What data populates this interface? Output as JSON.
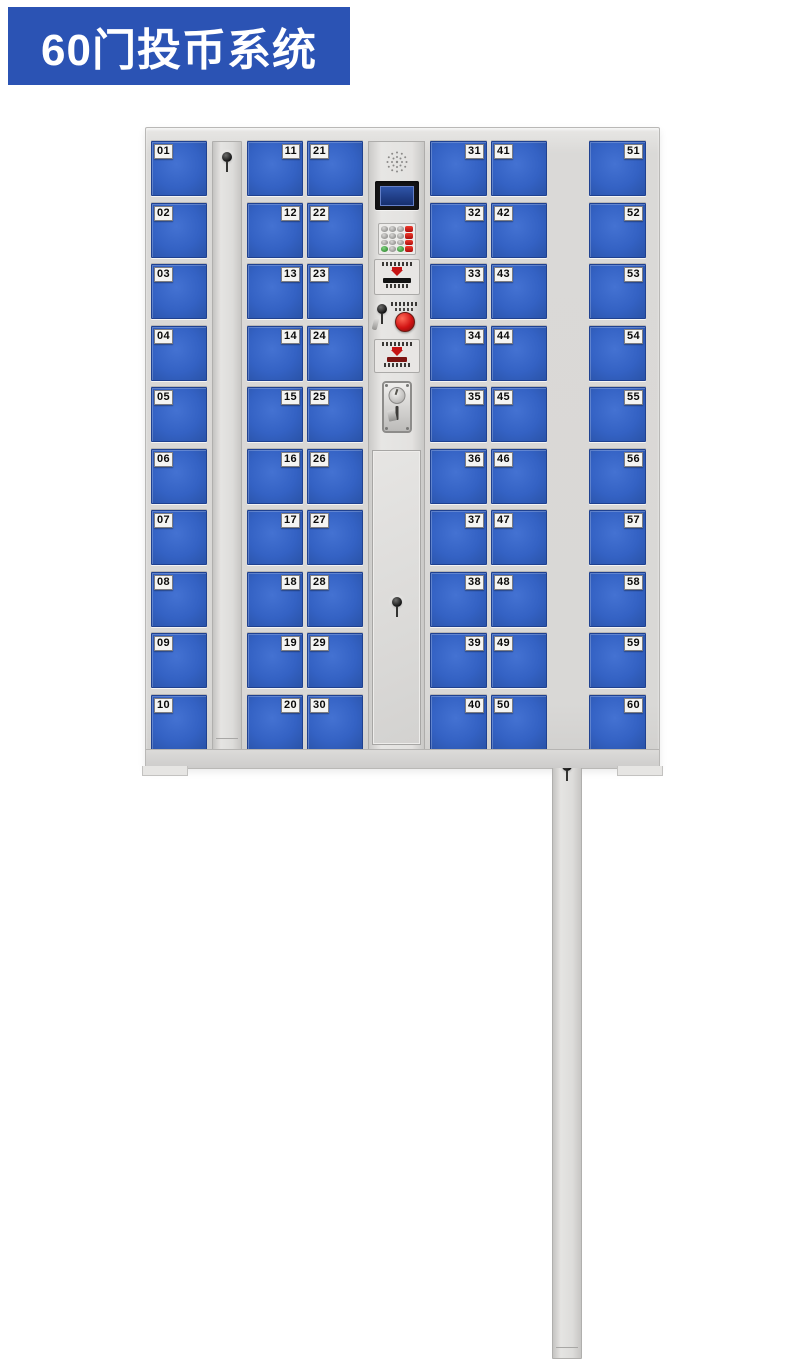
{
  "banner": {
    "title": "60门投币系统"
  },
  "colors": {
    "banner_bg": "#2b53b4",
    "banner_fg": "#ffffff",
    "door_blue": "#3462c4",
    "frame_gray": "#d9d8d6",
    "door_label_bg": "#f4f4f2",
    "lcd_screen_blue": "#23458f",
    "red_button": "#d21414",
    "keypad_red": "#c51f1a",
    "keypad_green": "#3a9a3a"
  },
  "locker": {
    "description": "60-door coin-operated storage cabinet, front view",
    "columns": [
      {
        "type": "doors",
        "label_side": "left",
        "doors": [
          "01",
          "02",
          "03",
          "04",
          "05",
          "06",
          "07",
          "08",
          "09",
          "10"
        ]
      },
      {
        "type": "lock",
        "name": "left-lock-strip"
      },
      {
        "type": "doors",
        "label_side": "right",
        "doors": [
          "11",
          "12",
          "13",
          "14",
          "15",
          "16",
          "17",
          "18",
          "19",
          "20"
        ]
      },
      {
        "type": "doors",
        "label_side": "left",
        "doors": [
          "21",
          "22",
          "23",
          "24",
          "25",
          "26",
          "27",
          "28",
          "29",
          "30"
        ]
      },
      {
        "type": "panel",
        "components": [
          "speaker-grille",
          "lcd-display",
          "keypad",
          "card-reader-slot",
          "master-keyhole",
          "red-button",
          "coin-instruction-label",
          "coin-acceptor",
          "service-door",
          "service-door-keyhole"
        ]
      },
      {
        "type": "doors",
        "label_side": "right",
        "doors": [
          "31",
          "32",
          "33",
          "34",
          "35",
          "36",
          "37",
          "38",
          "39",
          "40"
        ]
      },
      {
        "type": "doors",
        "label_side": "left",
        "doors": [
          "41",
          "42",
          "43",
          "44",
          "45",
          "46",
          "47",
          "48",
          "49",
          "50"
        ]
      },
      {
        "type": "lock",
        "name": "right-lock-strip"
      },
      {
        "type": "doors",
        "label_side": "right",
        "doors": [
          "51",
          "52",
          "53",
          "54",
          "55",
          "56",
          "57",
          "58",
          "59",
          "60"
        ]
      }
    ],
    "keypad": {
      "rows": [
        [
          "k",
          "k",
          "k",
          "r"
        ],
        [
          "k",
          "k",
          "k",
          "r"
        ],
        [
          "k",
          "k",
          "k",
          "r"
        ],
        [
          "g",
          "k",
          "g",
          "r"
        ]
      ]
    }
  }
}
